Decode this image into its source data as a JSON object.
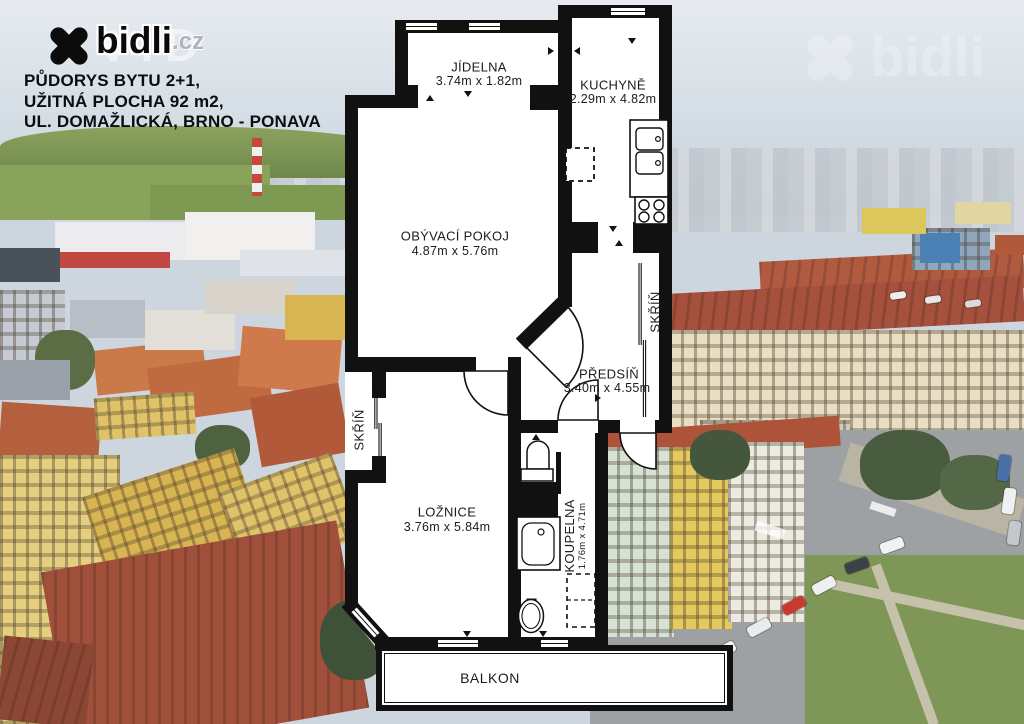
{
  "branding": {
    "logo_text": "bidli",
    "logo_tld": ".cz",
    "logo_ghost": "AVID",
    "watermark_text": "bidli"
  },
  "header": {
    "line1": "PŮDORYS BYTU 2+1,",
    "line2": "UŽITNÁ PLOCHA 92 m2,",
    "line3": "UL. DOMAŽLICKÁ, BRNO - PONAVA"
  },
  "floorplan": {
    "rooms": {
      "jidelna": {
        "name": "JÍDELNA",
        "dims": "3.74m x 1.82m"
      },
      "kuchyne": {
        "name": "KUCHYNĚ",
        "dims": "2.29m x 4.82m"
      },
      "obyvaci_pokoj": {
        "name": "OBÝVACÍ POKOJ",
        "dims": "4.87m x 5.76m"
      },
      "predsin": {
        "name": "PŘEDSÍŇ",
        "dims": "3.40m x 4.55m"
      },
      "loznice": {
        "name": "LOŽNICE",
        "dims": "3.76m x 5.84m"
      },
      "koupelna": {
        "name": "KOUPELNA",
        "dims": "1.76m x 4.71m"
      },
      "skrin_predsin": {
        "name": "SKŘÍŇ"
      },
      "skrin_loznice": {
        "name": "SKŘÍŇ"
      },
      "balkon": {
        "name": "BALKON"
      }
    },
    "colors": {
      "wall": "#111111",
      "room_fill": "#ffffff",
      "label": "#1c1c1c"
    }
  }
}
